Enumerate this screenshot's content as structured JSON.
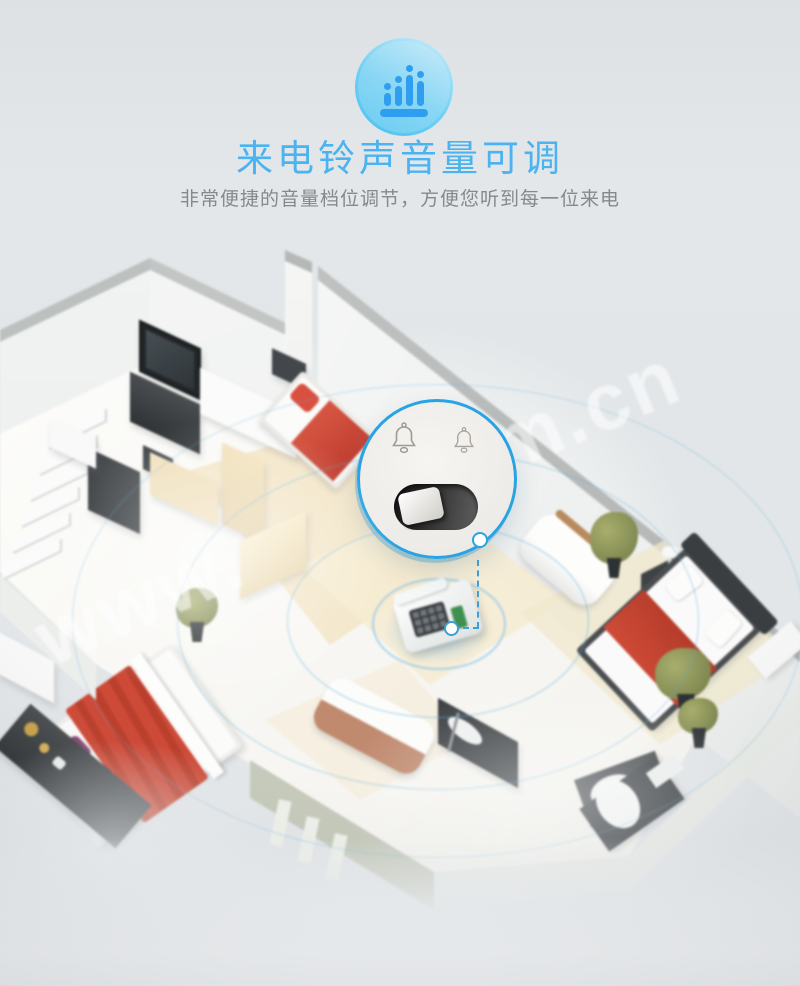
{
  "colors": {
    "accent_blue": "#4ab3f0",
    "icon_blue": "#2f9ef0",
    "circle_stroke": "#49c2f1",
    "subtitle_gray": "#85898d",
    "ripple_blue": "#58aedd",
    "ring_blue": "#29a3e3",
    "blanket_red": "#cd4a37",
    "pillow_purple": "#8c4a77",
    "watermark": "rgba(255,255,255,0.55)"
  },
  "header": {
    "icon": "volume-level-bars",
    "title": "来电铃声音量可调",
    "subtitle": "非常便捷的音量档位调节，方便您听到每一位来电"
  },
  "watermark": {
    "segment_left": "www.",
    "segment_right": ".com.cn"
  },
  "callout": {
    "icons": [
      "bell-outline",
      "bell-outline"
    ],
    "control": "ring-volume-slider-switch"
  },
  "illustration": {
    "type": "isometric-house-cutaway",
    "subject": "landline-phone-ring-coverage",
    "phone": "landline-telephone",
    "ripples": 3
  }
}
